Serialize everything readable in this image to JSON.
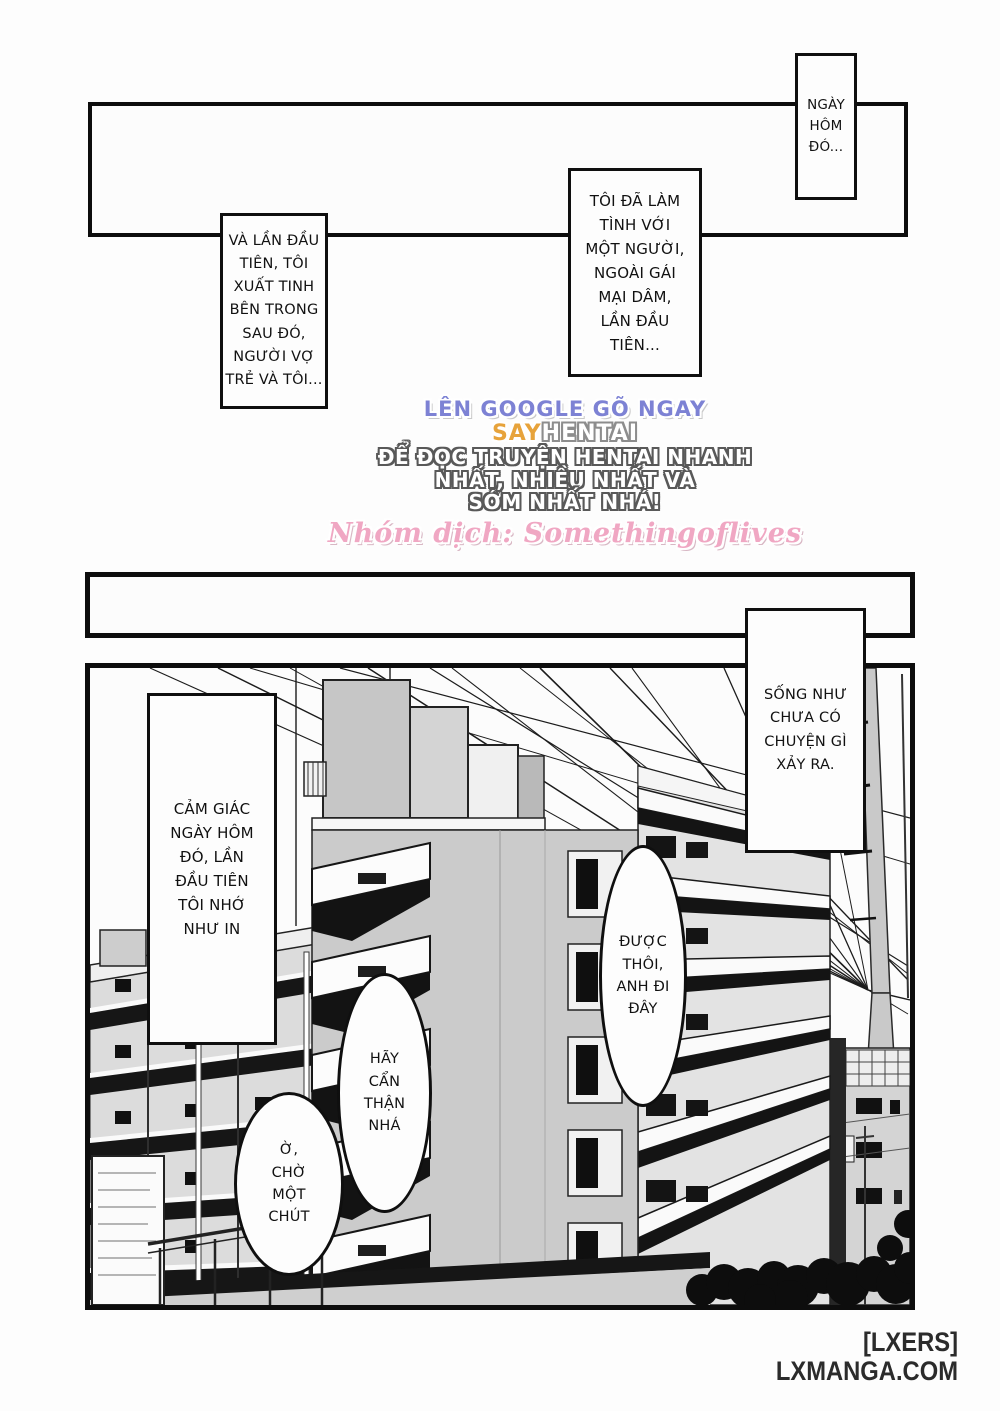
{
  "page": {
    "background": "#fdfdfd",
    "ink": "#0d0d0d"
  },
  "captions": {
    "top_right": "NGÀY\nHÔM\nĐÓ...",
    "center": "TÔI ĐÃ LÀM\nTÌNH VỚI\nMỘT NGƯỜI,\nNGOÀI GÁI\nMẠI DÂM,\nLẦN ĐẦU\nTIÊN...",
    "left": "VÀ LẦN ĐẦU\nTIÊN, TÔI\nXUẤT TINH\nBÊN TRONG\nSAU ĐÓ,\nNGƯỜI VỢ\nTRẺ VÀ TÔI..."
  },
  "watermark": {
    "line1": "LÊN GOOGLE GÕ NGAY",
    "line2_highlight": "SAY",
    "line2_rest": "HENTAI",
    "line3": "ĐỂ ĐỌC TRUYỆN HENTAI NHANH",
    "line4": "NHẤT, NHIỀU NHẤT VÀ",
    "line5": "SỚM NHẤT NHÁ!",
    "credit": "Nhóm dịch: Somethingoflives",
    "colors": {
      "line1": "#7d82d4",
      "highlight": "#e7a33b",
      "body_fill": "#ffffff",
      "credit": "#f0a7c3"
    }
  },
  "panel3": {
    "caption_right": "SỐNG NHƯ\nCHƯA CÓ\nCHUYỆN GÌ\nXẢY RA.",
    "caption_left": "CẢM GIÁC\nNGÀY HÔM\nĐÓ, LẦN\nĐẦU TIÊN\nTÔI NHỚ\nNHƯ IN",
    "bubble_right": "ĐƯỢC\nTHÔI,\nANH ĐI\nĐÂY",
    "bubble_center": "HÃY\nCẨN\nTHẬN\nNHÁ",
    "bubble_left": "Ờ,\nCHỜ\nMỘT\nCHÚT"
  },
  "footer": {
    "credit": "[LXERS]",
    "site": "LXMANGA.COM"
  }
}
